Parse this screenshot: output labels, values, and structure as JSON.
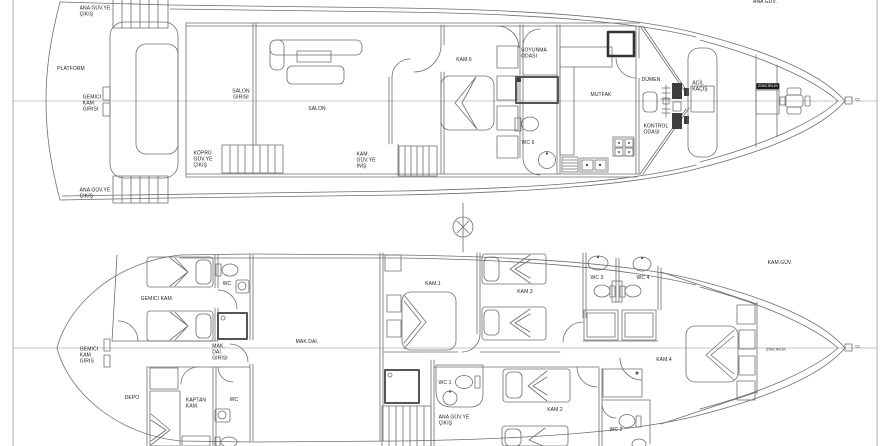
{
  "meta": {
    "background": "#ffffff",
    "line_color": "#6e6e6e",
    "text_color": "#1c1c1c"
  },
  "plan": {
    "upper_deck": {
      "labels": [
        {
          "id": "upper-deck-name",
          "lines": [
            "ANA GÜV."
          ],
          "x": 765,
          "y": 3
        },
        {
          "id": "ana-guv-ye-cikis-top",
          "lines": [
            "ANA GÜV.YE",
            "ÇIKIŞ"
          ],
          "x": 95,
          "y": 12
        },
        {
          "id": "platform",
          "lines": [
            "PLATFORM"
          ],
          "x": 71,
          "y": 70
        },
        {
          "id": "gemici-kam-girisi-upper",
          "lines": [
            "GEMICI",
            "KAM.",
            "GIRISI"
          ],
          "x": 92,
          "y": 104
        },
        {
          "id": "ana-guv-ye-cikis-bottom",
          "lines": [
            "ANA GÜV.YE",
            "ÇIKIŞ"
          ],
          "x": 95,
          "y": 194
        },
        {
          "id": "salon-girisi",
          "lines": [
            "SALON",
            "GIRISI"
          ],
          "x": 241,
          "y": 95,
          "style": "center"
        },
        {
          "id": "kopru-guv-ye-cikis",
          "lines": [
            "KÖPRÜ",
            "GÜV.YE",
            "ÇIKIŞ"
          ],
          "x": 203,
          "y": 160
        },
        {
          "id": "salon",
          "lines": [
            "SALON"
          ],
          "x": 317,
          "y": 110
        },
        {
          "id": "kam-guv-ye-inis",
          "lines": [
            "KAM.",
            "GÜV.YE",
            "İNİŞ"
          ],
          "x": 366,
          "y": 161
        },
        {
          "id": "kam-6",
          "lines": [
            "KAM.6"
          ],
          "x": 464,
          "y": 61
        },
        {
          "id": "soyunma-odasi",
          "lines": [
            "SOYUNMA",
            "ODASI"
          ],
          "x": 534,
          "y": 54
        },
        {
          "id": "wc-6",
          "lines": [
            "WC 6"
          ],
          "x": 528,
          "y": 144
        },
        {
          "id": "mutfak",
          "lines": [
            "MUTFAK"
          ],
          "x": 601,
          "y": 96
        },
        {
          "id": "dumen",
          "lines": [
            "DÜMEN"
          ],
          "x": 651,
          "y": 81
        },
        {
          "id": "kontrol-odasi",
          "lines": [
            "KONTROL",
            "ODASI"
          ],
          "x": 656,
          "y": 130
        },
        {
          "id": "acil-kacis",
          "lines": [
            "ACİL",
            "KAÇIŞ"
          ],
          "x": 700,
          "y": 87
        },
        {
          "id": "zincirlik-upper",
          "lines": [
            "ZİNCİRLİK"
          ],
          "x": 768,
          "y": 86,
          "style": "inverse"
        },
        {
          "id": "cl-upper",
          "lines": [
            "CL"
          ],
          "x": 858,
          "y": 100,
          "style": "tiny"
        }
      ]
    },
    "lower_deck": {
      "labels": [
        {
          "id": "lower-deck-name",
          "lines": [
            "KAM.GÜV."
          ],
          "x": 780,
          "y": 264
        },
        {
          "id": "gemici-kam",
          "lines": [
            "GEMICI KAM."
          ],
          "x": 157,
          "y": 300
        },
        {
          "id": "wc-crew",
          "lines": [
            "WC"
          ],
          "x": 227,
          "y": 285
        },
        {
          "id": "gemici-kam-giris-lower",
          "lines": [
            "GEMICI",
            "KAM.",
            "GIRIS"
          ],
          "x": 89,
          "y": 356
        },
        {
          "id": "mak-dai-girisi",
          "lines": [
            "MAK.",
            "DAİ.",
            "GIRISI"
          ],
          "x": 220,
          "y": 353
        },
        {
          "id": "mak-dai",
          "lines": [
            "MAK.DAİ."
          ],
          "x": 307,
          "y": 343
        },
        {
          "id": "depo",
          "lines": [
            "DEPO"
          ],
          "x": 132,
          "y": 399
        },
        {
          "id": "kaptan-kam",
          "lines": [
            "KAPTAN",
            "KAM."
          ],
          "x": 196,
          "y": 404
        },
        {
          "id": "wc-captain",
          "lines": [
            "WC"
          ],
          "x": 234,
          "y": 401
        },
        {
          "id": "kam-1",
          "lines": [
            "KAM.1"
          ],
          "x": 433,
          "y": 285
        },
        {
          "id": "kam-3",
          "lines": [
            "KAM.3"
          ],
          "x": 525,
          "y": 293
        },
        {
          "id": "wc-3",
          "lines": [
            "WC 3"
          ],
          "x": 597,
          "y": 279
        },
        {
          "id": "wc-4",
          "lines": [
            "WC 4"
          ],
          "x": 643,
          "y": 279
        },
        {
          "id": "kam-4",
          "lines": [
            "KAM.4"
          ],
          "x": 664,
          "y": 361
        },
        {
          "id": "wc-1",
          "lines": [
            "WC 1"
          ],
          "x": 445,
          "y": 384
        },
        {
          "id": "ana-guv-ye-cikis-lower",
          "lines": [
            "ANA GÜV.YE",
            "ÇIKIŞ"
          ],
          "x": 454,
          "y": 421
        },
        {
          "id": "kam-2",
          "lines": [
            "KAM.2"
          ],
          "x": 555,
          "y": 411
        },
        {
          "id": "wc-2",
          "lines": [
            "WC 2"
          ],
          "x": 616,
          "y": 431
        },
        {
          "id": "zincirlik-lower",
          "lines": [
            "ZİNCİRLİK"
          ],
          "x": 776,
          "y": 350,
          "style": "tiny"
        },
        {
          "id": "cl-lower",
          "lines": [
            "CL"
          ],
          "x": 858,
          "y": 347,
          "style": "tiny"
        }
      ]
    }
  }
}
